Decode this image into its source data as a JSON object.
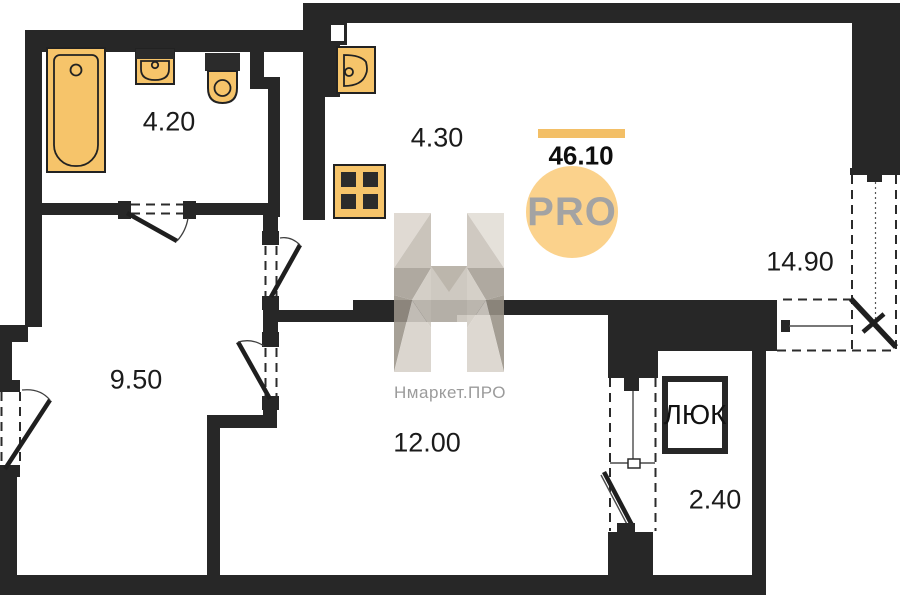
{
  "plan": {
    "total_area_label": "46.10",
    "rooms": [
      {
        "name": "bathroom",
        "area_label": "4.20"
      },
      {
        "name": "kitchen",
        "area_label": "4.30"
      },
      {
        "name": "hallway",
        "area_label": "9.50"
      },
      {
        "name": "living-room",
        "area_label": "12.00"
      },
      {
        "name": "bedroom",
        "area_label": "14.90"
      },
      {
        "name": "wardrobe",
        "area_label": "2.40"
      }
    ],
    "hatch_label": "ЛЮК"
  },
  "branding": {
    "logo_circle_text": "PRO",
    "watermark_caption": "Нмаркет.ПРО"
  },
  "colors": {
    "wall": "#272727",
    "fixture_fill": "#f6c46a",
    "fixture_stroke": "#222222",
    "accent_bar": "#f3bf66",
    "logo_circle_fill": "#fbd28c",
    "logo_text": "#a3a3a3",
    "watermark_gray": "#9b9b9b",
    "label_text": "#1b1b1b"
  }
}
